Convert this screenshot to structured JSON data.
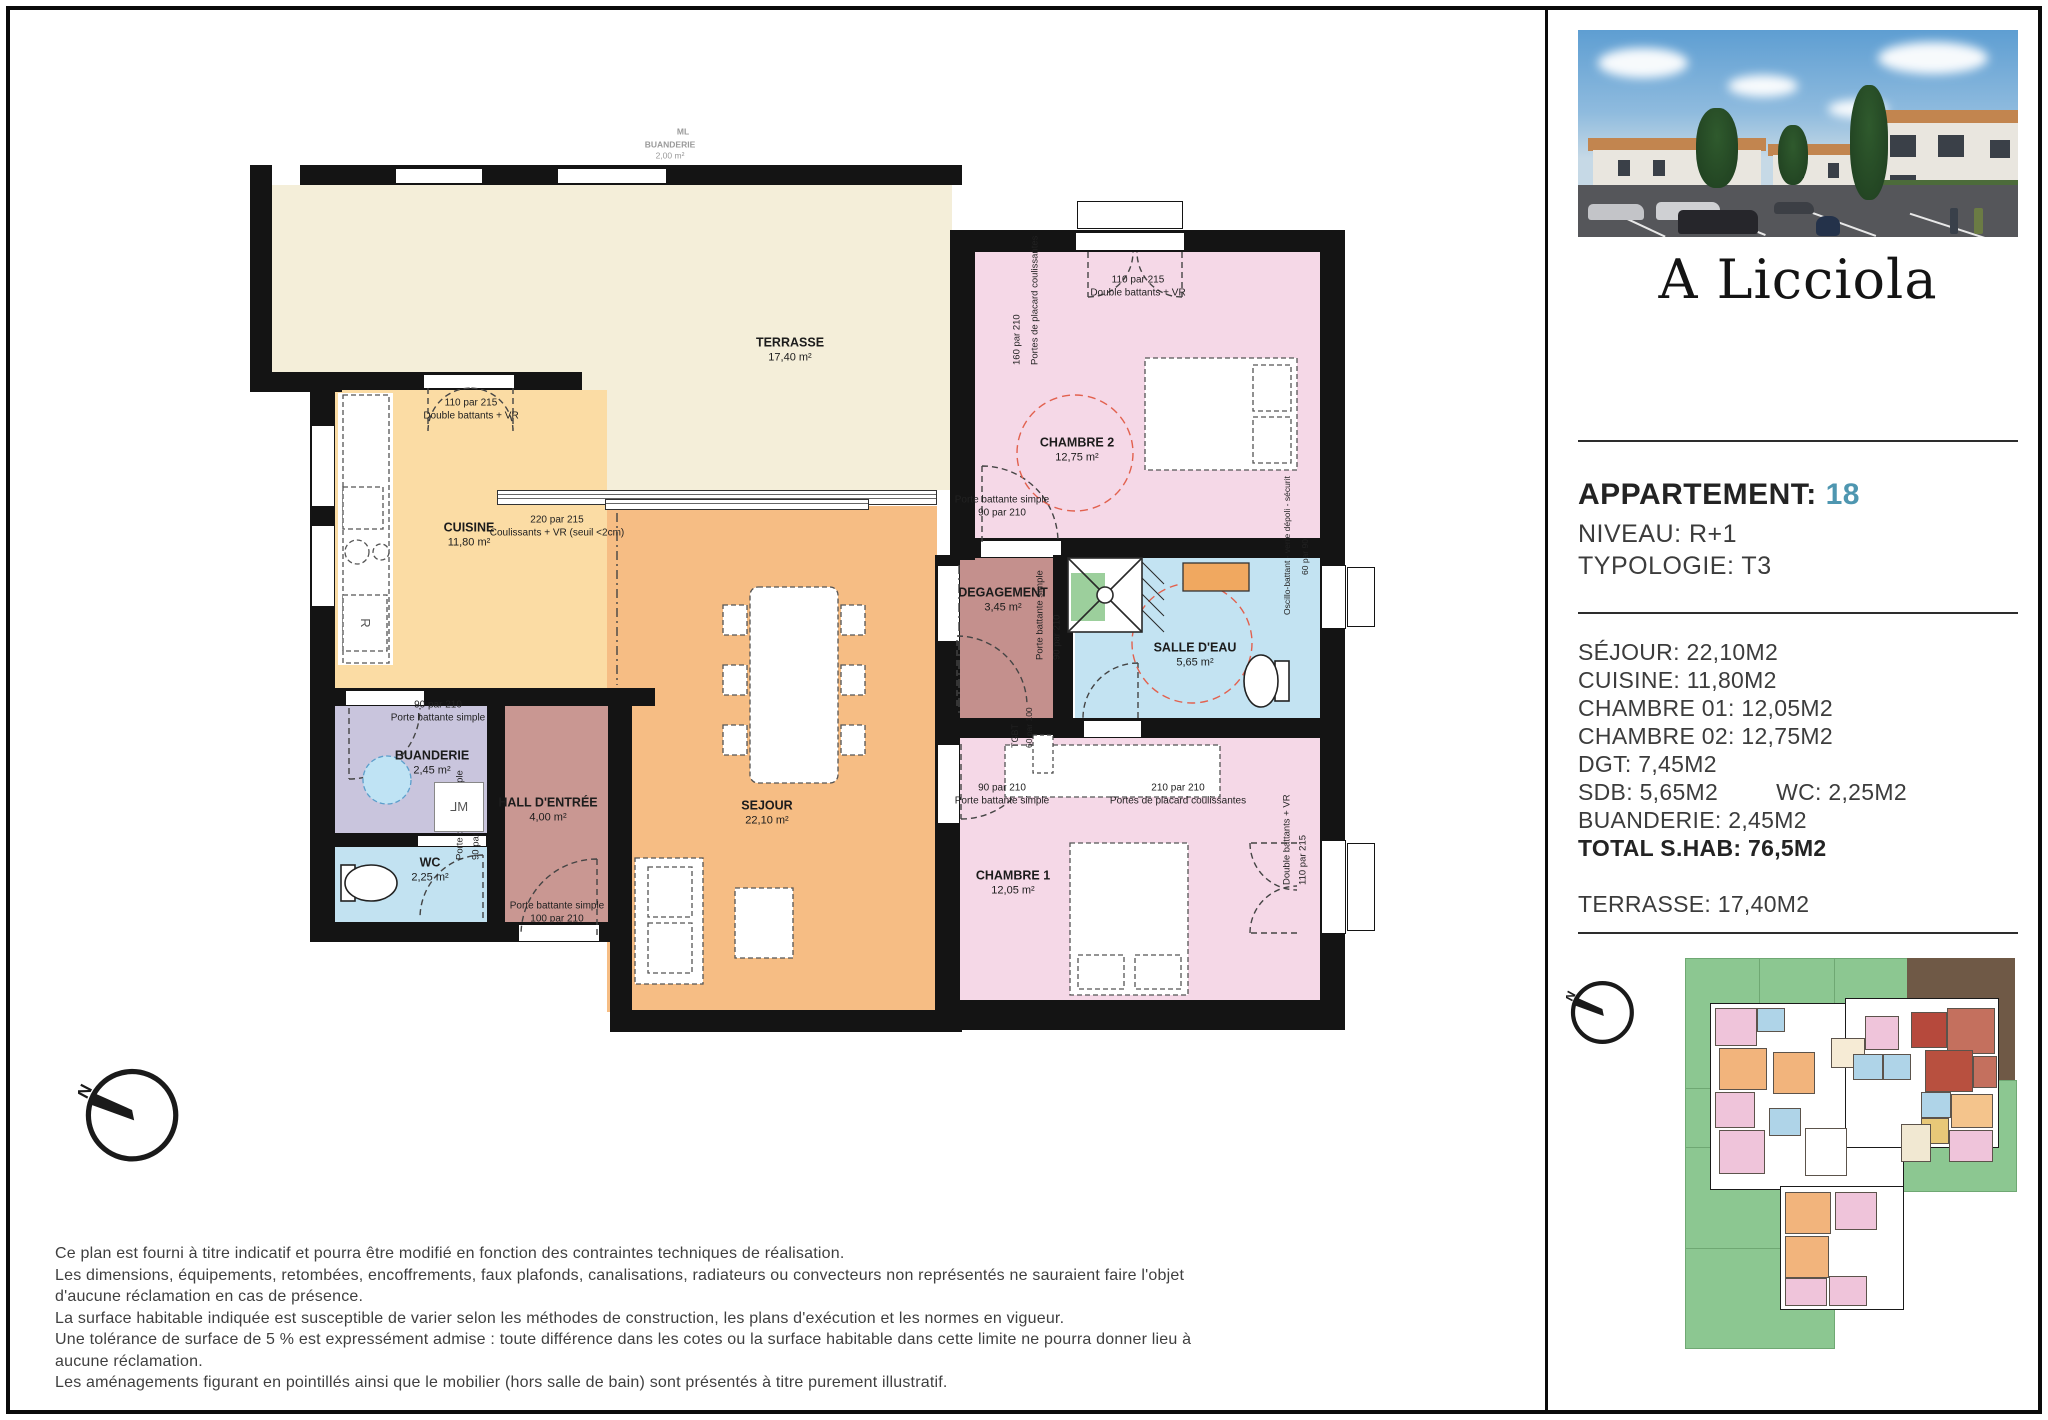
{
  "brand": {
    "logo": "A Licciola"
  },
  "header": {
    "apartment_label": "APPARTEMENT:",
    "apartment_number": "18",
    "niveau": "NIVEAU: R+1",
    "typologie": "TYPOLOGIE: T3",
    "accent_color": "#4e96b0"
  },
  "details": {
    "rows": [
      "SÉJOUR: 22,10M2",
      "CUISINE: 11,80M2",
      "CHAMBRE 01: 12,05M2",
      "CHAMBRE 02: 12,75M2",
      "DGT: 7,45M2"
    ],
    "sdb": "SDB: 5,65M2",
    "wc": "WC: 2,25M2",
    "buanderie": "BUANDERIE: 2,45M2",
    "total": "TOTAL S.HAB: 76,5M2",
    "terrasse": "TERRASSE: 17,40M2"
  },
  "plan": {
    "faint": {
      "ml": "ML",
      "buanderie_name": "BUANDERIE",
      "buanderie_area": "2,00 m²",
      "dim": "210",
      "chambre_name": "CHAMBRE",
      "chambre_area": "13,15 m²"
    },
    "rooms": {
      "terrasse": {
        "name": "TERRASSE",
        "area": "17,40 m²"
      },
      "cuisine": {
        "name": "CUISINE",
        "area": "11,80 m²"
      },
      "sejour": {
        "name": "SEJOUR",
        "area": "22,10 m²"
      },
      "chambre1": {
        "name": "CHAMBRE 1",
        "area": "12,05 m²"
      },
      "chambre2": {
        "name": "CHAMBRE 2",
        "area": "12,75 m²"
      },
      "degagement": {
        "name": "DEGAGEMENT",
        "area": "3,45 m²"
      },
      "salle_eau": {
        "name": "SALLE D'EAU",
        "area": "5,65 m²"
      },
      "buanderie": {
        "name": "BUANDERIE",
        "area": "2,45 m²"
      },
      "wc": {
        "name": "WC",
        "area": "2,25 m²"
      },
      "hall": {
        "name": "HALL D'ENTRÉE",
        "area": "4,00 m²"
      }
    },
    "doors": {
      "cuisine_win_dim": "110 par 215",
      "cuisine_win": "Double battants + VR",
      "slide_dim": "220 par 215",
      "slide": "Coulissants + VR (seuil <2cm)",
      "c2_win_dim": "110 par 215",
      "c2_win": "Double battants + VR",
      "c2_placard": "Portes de placard coulissantes",
      "c2_placard_dim": "160 par 210",
      "c2_door": "Porte battante simple",
      "c2_door_dim": "90 par 210",
      "deg_door": "Porte battante simple",
      "deg_door_dim": "90 par 210",
      "tgbt": "TGBT",
      "tgbt_dim": "60 par 100",
      "sde_win": "Oscillo-battant - verre dépoli - sécurit",
      "sde_win_dim": "60 par 90",
      "c1_door_dim": "90 par 210",
      "c1_door": "Porte battante simple",
      "c1_placard_dim": "210 par 210",
      "c1_placard": "Portes de placard coulissantes",
      "c1_win": "Double battants + VR",
      "c1_win_dim": "110 par 215",
      "bu_door_dim": "90 par 210",
      "bu_door": "Porte battante simple",
      "wc_door": "Porte battante simple",
      "wc_door_dim": "90 par 210",
      "hall_door": "Porte battante simple",
      "hall_door_dim": "100 par 210",
      "ml": "ML",
      "fridge": "R"
    }
  },
  "compass": {
    "north": "N"
  },
  "disclaimer": [
    "Ce plan est fourni à titre indicatif et pourra être modifié en fonction des contraintes techniques de réalisation.",
    "Les dimensions, équipements, retombées, encoffrements, faux plafonds, canalisations, radiateurs ou convecteurs non représentés ne sauraient faire l'objet",
    "d'aucune réclamation en cas de présence.",
    "La surface habitable indiquée est susceptible de varier selon les méthodes de construction, les plans d'exécution et les normes en vigueur.",
    "Une tolérance de surface de 5 % est expressément admise : toute différence dans les cotes ou la surface habitable dans cette limite ne pourra donner lieu à",
    "aucune réclamation.",
    "Les aménagements figurant en pointillés ainsi que le mobilier (hors salle de bain) sont présentés à titre purement illustratif."
  ]
}
